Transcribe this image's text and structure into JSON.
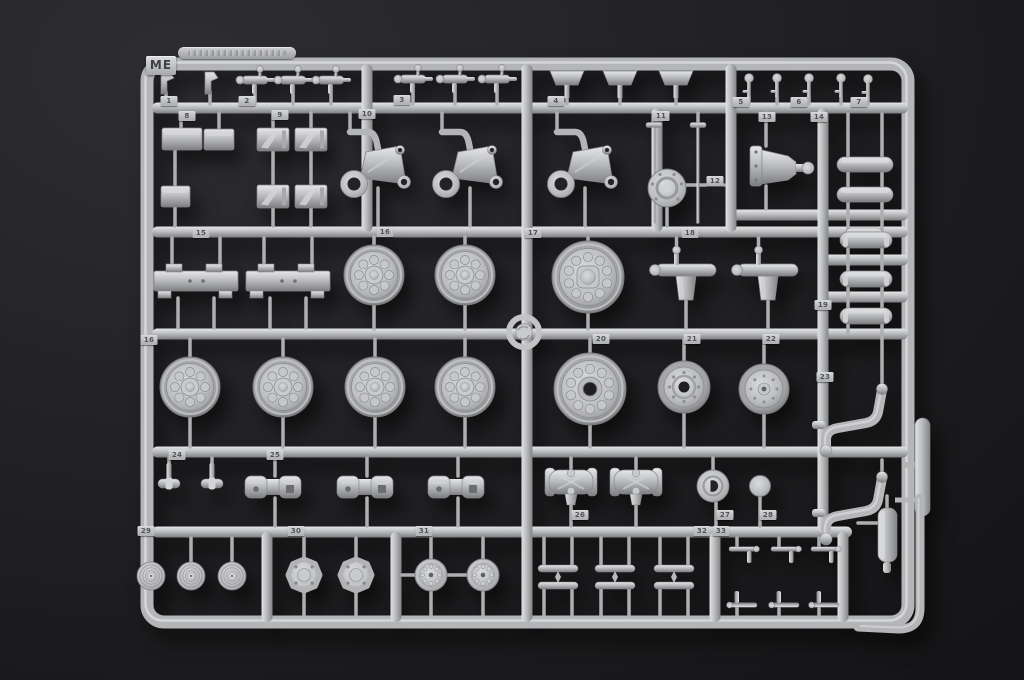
{
  "scene": {
    "description": "Photograph of a light gray injection-molded plastic model kit sprue (parts runner ME) on a dark studio background",
    "background_color": "#1c1c1e",
    "plastic_base_color": "#b6b7b9",
    "plastic_highlight_color": "#e5e6e8",
    "plastic_shadow_color": "#7a7b7d",
    "tag_plate_color": "#c9cacc",
    "tag_text_color": "#515256"
  },
  "sprue": {
    "letter": "ME"
  },
  "tags": [
    "1",
    "2",
    "3",
    "4",
    "5",
    "6",
    "7",
    "8",
    "9",
    "10",
    "11",
    "12",
    "13",
    "14",
    "15",
    "16",
    "17",
    "18",
    "19",
    "20",
    "21",
    "22",
    "23",
    "24",
    "25",
    "26",
    "27",
    "28",
    "29",
    "30",
    "31",
    "32",
    "33"
  ],
  "parts_visible": [
    {
      "number": "1",
      "shape": "small hook bracket",
      "qty": 2
    },
    {
      "number": "2",
      "shape": "lever pin assembly",
      "qty": 3
    },
    {
      "number": "3",
      "shape": "lever pin assembly",
      "qty": 3
    },
    {
      "number": "4",
      "shape": "trapezoid flap",
      "qty": 3
    },
    {
      "number": "5",
      "shape": "round-head pin",
      "qty": 2
    },
    {
      "number": "6",
      "shape": "round-head pin",
      "qty": 2
    },
    {
      "number": "7",
      "shape": "round-head pin",
      "qty": 1
    },
    {
      "number": "8",
      "shape": "rectangular stowage box",
      "qty": 3
    },
    {
      "number": "9",
      "shape": "angled rib plate",
      "qty": 4
    },
    {
      "number": "10",
      "shape": "triangular suspension bracket with ring",
      "qty": 3
    },
    {
      "number": "11",
      "shape": "long T-head pin",
      "qty": 2
    },
    {
      "number": "12",
      "shape": "domed round cap",
      "qty": 1
    },
    {
      "number": "13",
      "shape": "axle input housing with ball end",
      "qty": 1
    },
    {
      "number": "14",
      "shape": "smooth cylinder",
      "qty": 3
    },
    {
      "number": "15",
      "shape": "notched mounting plate",
      "qty": 2
    },
    {
      "number": "16",
      "shape": "road wheel with 8 bolts",
      "qty": 6
    },
    {
      "number": "17",
      "shape": "large wheel with 10 bolts and hub",
      "qty": 1
    },
    {
      "number": "18",
      "shape": "axle shaft with boss",
      "qty": 2
    },
    {
      "number": "19",
      "shape": "ribbed cylinder tank",
      "qty": 3
    },
    {
      "number": "20",
      "shape": "large wheel with 10 bolts and center hole",
      "qty": 1
    },
    {
      "number": "21",
      "shape": "small wheel with center hole",
      "qty": 1
    },
    {
      "number": "22",
      "shape": "small wheel with center hub",
      "qty": 1
    },
    {
      "number": "23",
      "shape": "curved support arm",
      "qty": 2
    },
    {
      "number": "24",
      "shape": "small pipe clamp",
      "qty": 2
    },
    {
      "number": "25",
      "shape": "twin-pad link block",
      "qty": 3
    },
    {
      "number": "26",
      "shape": "differential housing",
      "qty": 2
    },
    {
      "number": "27",
      "shape": "round cap with D-shaped hole",
      "qty": 1
    },
    {
      "number": "28",
      "shape": "plain disc",
      "qty": 1
    },
    {
      "number": "29",
      "shape": "ribbed dome",
      "qty": 3
    },
    {
      "number": "30",
      "shape": "scalloped hub",
      "qty": 2
    },
    {
      "number": "31",
      "shape": "bolted hub disc",
      "qty": 2
    },
    {
      "number": "32",
      "shape": "narrow spring bar",
      "qty": 6
    },
    {
      "number": "33",
      "shape": "small T-lever",
      "qty": 6
    }
  ]
}
